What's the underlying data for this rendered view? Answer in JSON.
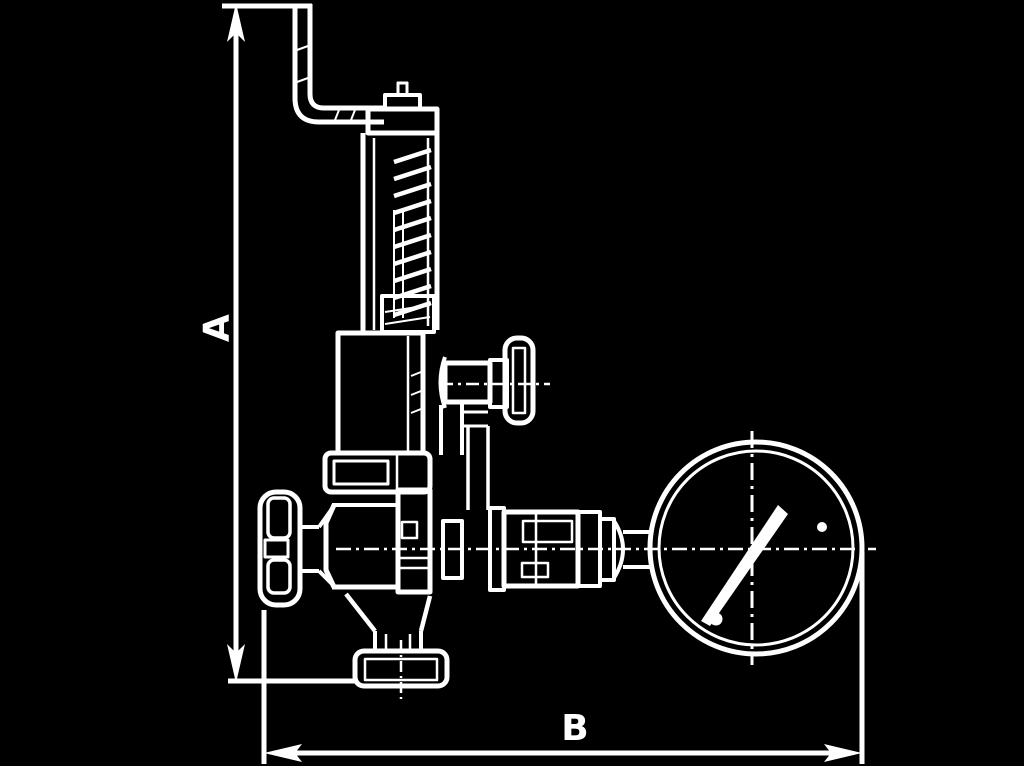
{
  "canvas": {
    "width": 1024,
    "height": 766,
    "background_color": "#000000",
    "line_color": "#ffffff"
  },
  "diagram": {
    "type": "technical-line-drawing",
    "subject": "safety relief valve with pressure gauge, dimensioned outline drawing",
    "dimensions": {
      "a_label": "A",
      "b_label": "B"
    },
    "parts": [
      "release-lever-icon",
      "cap-nut-icon",
      "spring-bonnet-icon",
      "spring-coils-icon",
      "gauge-isolation-valve-icon",
      "isolation-valve-knob-icon",
      "bonnet-flange-icon",
      "handwheel-icon",
      "valve-body-icon",
      "outlet-flange-icon",
      "gauge-piping-icon",
      "pressure-gauge-icon",
      "gauge-needle-icon"
    ]
  }
}
